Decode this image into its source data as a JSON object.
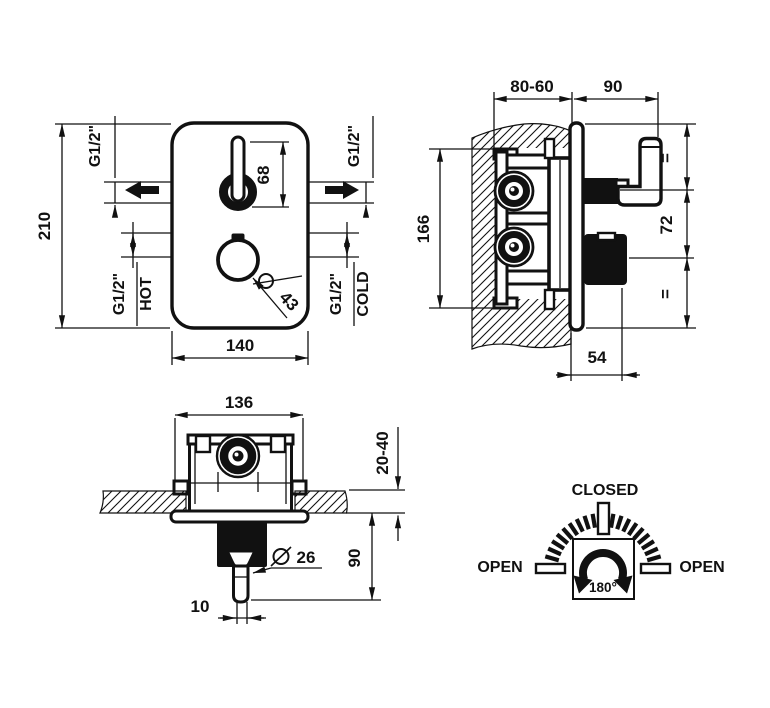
{
  "accent_color": "#111111",
  "background_color": "#ffffff",
  "views": {
    "front": {
      "height": "210",
      "width": "140",
      "lever_length": "68",
      "knob_diameter": "43",
      "outlet_left_thread": "G1/2\"",
      "outlet_right_thread": "G1/2\"",
      "hot_thread": "G1/2\"",
      "hot_label": "HOT",
      "cold_thread": "G1/2\"",
      "cold_label": "COLD"
    },
    "side": {
      "recess_depth": "80-60",
      "handle_projection": "90",
      "body_height": "166",
      "axis_spacing": "72",
      "equal_top": "=",
      "equal_bottom": "=",
      "knob_projection": "54"
    },
    "section": {
      "body_width": "136",
      "wall_thickness": "20-40",
      "stem_projection": "90",
      "collar_diameter": "26",
      "stem_width": "10"
    },
    "rotation": {
      "closed_label": "CLOSED",
      "open_left_label": "OPEN",
      "open_right_label": "OPEN",
      "angle_label": "180°"
    }
  }
}
